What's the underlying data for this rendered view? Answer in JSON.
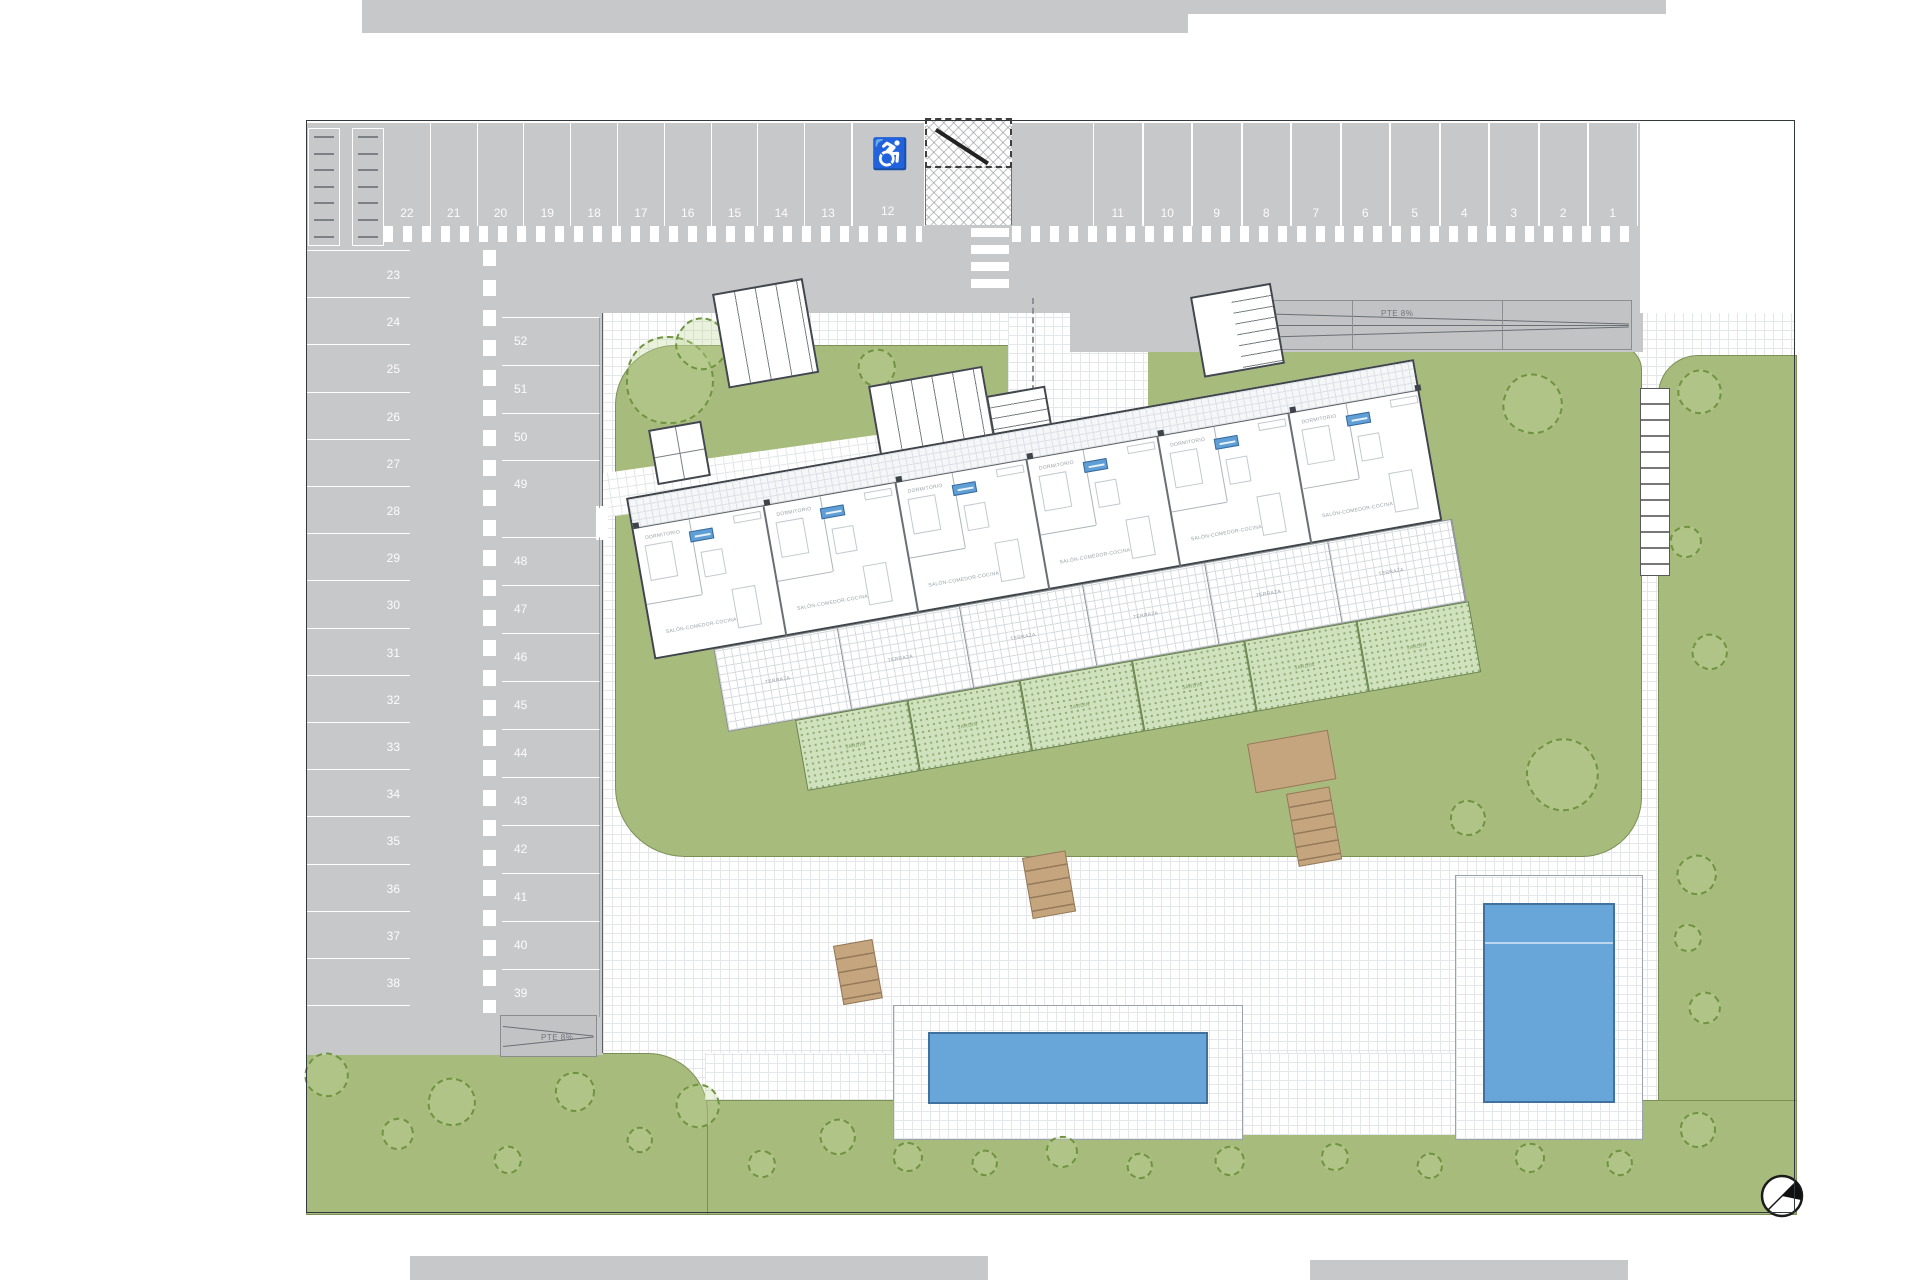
{
  "site": {
    "asphalt_color": "#c7c8ca",
    "lawn_color": "#a7bb7d",
    "garden_color": "#cfe2bd",
    "pool_color": "#68a6d9",
    "wood_color": "#c4a57d",
    "unit_marker_color": "#5f9fd6",
    "boundary_color": "#33383d"
  },
  "parking": {
    "top_row_a": [
      "22",
      "21",
      "20",
      "19",
      "18",
      "17",
      "16",
      "15",
      "14",
      "13"
    ],
    "handicap_space": "12",
    "top_row_b": [
      "11",
      "10",
      "9",
      "8",
      "7",
      "6",
      "5",
      "4",
      "3",
      "2",
      "1"
    ],
    "left_column": [
      "23",
      "24",
      "25",
      "26",
      "27",
      "28",
      "29",
      "30",
      "31",
      "32",
      "33",
      "34",
      "35",
      "36",
      "37",
      "38"
    ],
    "middle_upper": [
      "52",
      "51",
      "50",
      "49"
    ],
    "middle_lower": [
      "48",
      "47",
      "46",
      "45",
      "44",
      "43",
      "42",
      "41",
      "40",
      "39"
    ]
  },
  "labels": {
    "ramp": "PTE 8%",
    "terrace": "TERRAZA",
    "garden": "JARDÍN",
    "living": "SALÓN-COMEDOR-COCINA",
    "bedroom": "DORMITORIO"
  },
  "icons": {
    "accessible": "♿"
  },
  "building": {
    "unit_count": 6,
    "terrace_count": 6,
    "garden_count": 6
  },
  "trees": [
    [
      670,
      380,
      44
    ],
    [
      702,
      344,
      26
    ],
    [
      877,
      368,
      19
    ],
    [
      1533,
      404,
      30
    ],
    [
      1563,
      775,
      36
    ],
    [
      1468,
      818,
      18
    ],
    [
      1700,
      392,
      22
    ],
    [
      1686,
      542,
      16
    ],
    [
      1710,
      652,
      18
    ],
    [
      1697,
      875,
      20
    ],
    [
      1688,
      938,
      14
    ],
    [
      1705,
      1008,
      16
    ],
    [
      1698,
      1130,
      18
    ],
    [
      327,
      1075,
      22
    ],
    [
      398,
      1134,
      16
    ],
    [
      452,
      1102,
      24
    ],
    [
      508,
      1160,
      14
    ],
    [
      575,
      1092,
      20
    ],
    [
      640,
      1140,
      13
    ],
    [
      698,
      1106,
      22
    ],
    [
      762,
      1164,
      14
    ],
    [
      838,
      1137,
      18
    ],
    [
      908,
      1157,
      15
    ],
    [
      985,
      1163,
      13
    ],
    [
      1062,
      1152,
      16
    ],
    [
      1140,
      1166,
      13
    ],
    [
      1230,
      1161,
      15
    ],
    [
      1335,
      1157,
      14
    ],
    [
      1430,
      1166,
      13
    ],
    [
      1530,
      1158,
      15
    ],
    [
      1620,
      1163,
      13
    ]
  ]
}
